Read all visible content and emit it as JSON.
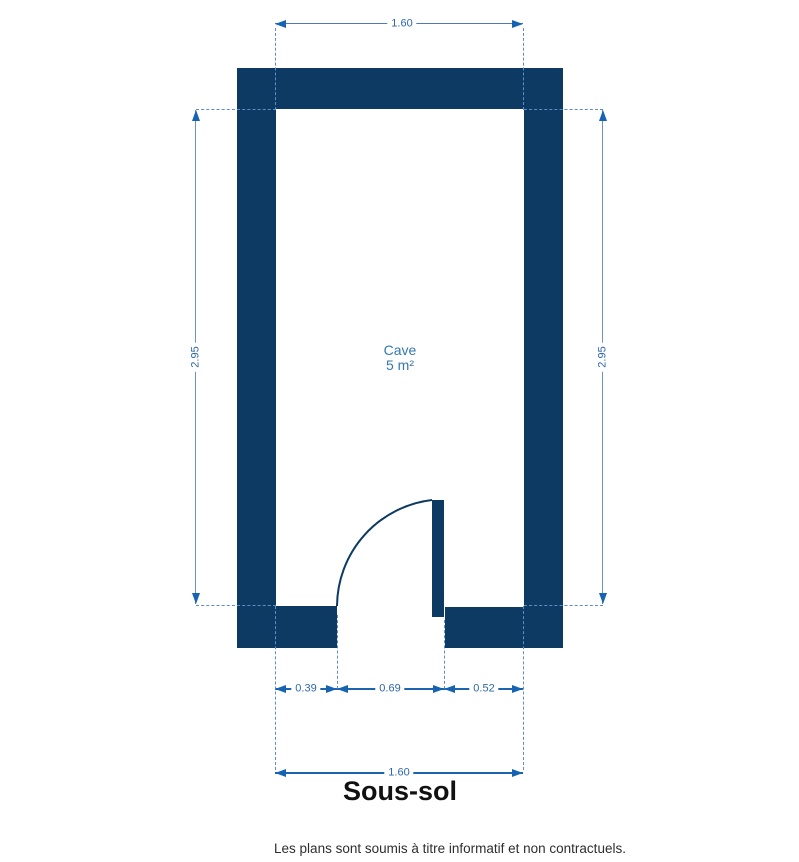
{
  "plan": {
    "room_label": "Cave",
    "room_area": "5 m²",
    "title": "Sous-sol",
    "disclaimer": "Les plans sont soumis à titre informatif et non contractuels.",
    "dimensions": {
      "top_width": "1.60",
      "left_height": "2.95",
      "right_height": "2.95",
      "bottom_left": "0.39",
      "bottom_door": "0.69",
      "bottom_right": "0.52",
      "bottom_total": "1.60"
    },
    "colors": {
      "wall": "#0d3a63",
      "dimension_arrow": "#1563b2",
      "dimension_text": "#2e67ab",
      "extension_line": "#5d8cc8",
      "room_text": "#3776b4",
      "title_text": "#111111",
      "disclaimer_text": "#2e2e2e"
    }
  }
}
